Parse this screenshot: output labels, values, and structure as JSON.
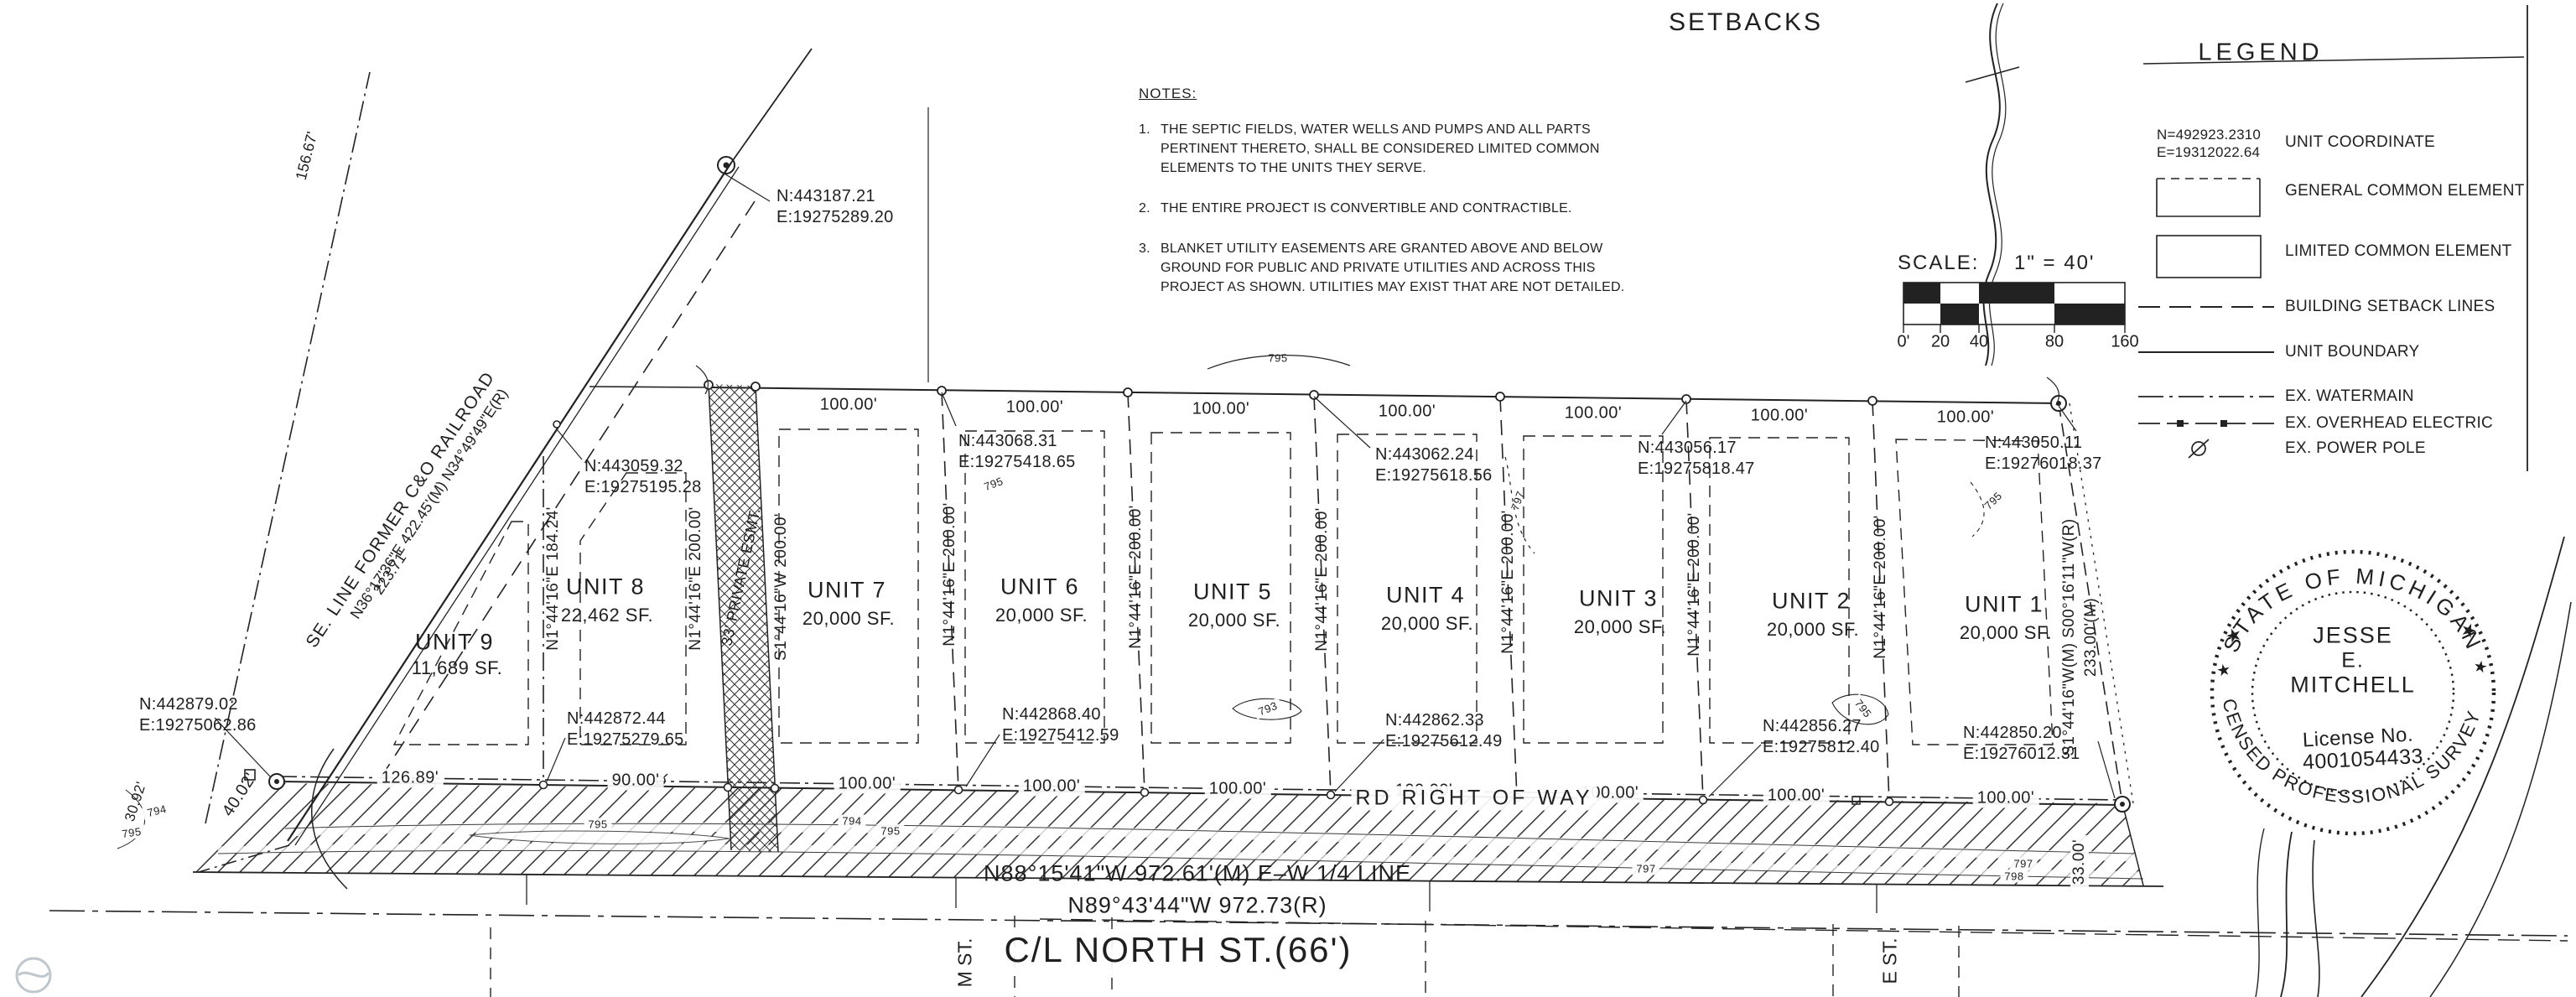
{
  "page": {
    "title": "SETBACKS",
    "ink": "#1f1f1f",
    "bg": "#ffffff"
  },
  "notes": {
    "title": "NOTES:",
    "items": [
      {
        "num": "1.",
        "lines": [
          "THE SEPTIC FIELDS, WATER WELLS AND PUMPS AND ALL PARTS",
          "PERTINENT THERETO, SHALL BE CONSIDERED LIMITED COMMON",
          "ELEMENTS TO THE UNITS THEY SERVE."
        ]
      },
      {
        "num": "2.",
        "lines": [
          "THE ENTIRE PROJECT IS CONVERTIBLE AND CONTRACTIBLE."
        ]
      },
      {
        "num": "3.",
        "lines": [
          "BLANKET UTILITY EASEMENTS ARE GRANTED ABOVE AND BELOW",
          "GROUND FOR PUBLIC AND PRIVATE UTILITIES AND ACROSS THIS",
          "PROJECT AS SHOWN. UTILITIES MAY EXIST THAT ARE NOT DETAILED."
        ]
      }
    ]
  },
  "legend": {
    "title": "LEGEND",
    "coord_sample": {
      "n": "N=492923.2310",
      "e": "E=19312022.64"
    },
    "items": [
      "UNIT COORDINATE",
      "GENERAL COMMON ELEMENT",
      "LIMITED COMMON ELEMENT",
      "BUILDING SETBACK LINES",
      "UNIT BOUNDARY",
      "EX. WATERMAIN",
      "EX. OVERHEAD ELECTRIC",
      "EX. POWER POLE"
    ]
  },
  "scale": {
    "label": "SCALE:",
    "ratio": "1\" = 40'",
    "ticks": [
      "0'",
      "20",
      "40",
      "80",
      "160"
    ]
  },
  "seal": {
    "arc_top": "STATE OF MICHIGAN",
    "arc_bottom": "LICENSED PROFESSIONAL SURVEYOR",
    "name1": "JESSE",
    "name2": "E.",
    "name3": "MITCHELL",
    "license_label": "License No.",
    "license_no": "4001054433",
    "star": "★"
  },
  "railroad": {
    "name": "SE. LINE FORMER C&O RAILROAD",
    "bearing": "N36°17'36\"E  422.45'(M)  N34°49'49\"E(R)",
    "dim_223": "223.71'",
    "dim_156": "156.67'"
  },
  "units": [
    {
      "name": "UNIT 9",
      "sf": "11,689 SF."
    },
    {
      "name": "UNIT 8",
      "sf": "22,462 SF."
    },
    {
      "name": "UNIT 7",
      "sf": "20,000 SF."
    },
    {
      "name": "UNIT 6",
      "sf": "20,000 SF."
    },
    {
      "name": "UNIT 5",
      "sf": "20,000 SF."
    },
    {
      "name": "UNIT 4",
      "sf": "20,000 SF."
    },
    {
      "name": "UNIT 3",
      "sf": "20,000 SF."
    },
    {
      "name": "UNIT 2",
      "sf": "20,000 SF."
    },
    {
      "name": "UNIT 1",
      "sf": "20,000 SF."
    }
  ],
  "coords": {
    "rr_top": {
      "n": "N:443187.21",
      "e": "E:19275289.20"
    },
    "u8_nw": {
      "n": "N:443059.32",
      "e": "E:19275195.28"
    },
    "u6_top": {
      "n": "N:443068.31",
      "e": "E:19275418.65"
    },
    "u4_top": {
      "n": "N:443062.24",
      "e": "E:19275618.56"
    },
    "u2_top": {
      "n": "N:443056.17",
      "e": "E:19275818.47"
    },
    "u1_top": {
      "n": "N:443050.11",
      "e": "E:19276018.37"
    },
    "sw": {
      "n": "N:442879.02",
      "e": "E:19275062.86"
    },
    "b1": {
      "n": "N:442872.44",
      "e": "E:19275279.65"
    },
    "b2": {
      "n": "N:442868.40",
      "e": "E:19275412.59"
    },
    "b3": {
      "n": "N:442862.33",
      "e": "E:19275612.49"
    },
    "b4": {
      "n": "N:442856.27",
      "e": "E:19275812.40"
    },
    "b5": {
      "n": "N:442850.20",
      "e": "E:19276012.31"
    }
  },
  "dims": {
    "d100": "100.00'",
    "d126": "126.89'",
    "d90": "90.00'",
    "d40": "40.02'",
    "d30": "30.92'",
    "d33": "33.00'"
  },
  "bearings": {
    "u9_east": "N1°44'16\"E  184.24'",
    "divider": "N1°44'16\"E  200.00'",
    "easement_w": "N1°44'16\"E  200.00'",
    "easement_label": "33' PRIVATE ESMT.",
    "easement_e": "S1°44'16\"W  200.00'",
    "east_line1": "S1°44'16\"W(M) S00°16'11\"W(R)",
    "east_line2": "233.00'(M)"
  },
  "road": {
    "band_label": "RD RIGHT OF WAY",
    "quarter_m": "N88°15'41\"W  972.61'(M)  E–W 1/4 LINE",
    "quarter_r": "N89°43'44\"W  972.73(R)",
    "street": "C/L NORTH ST.(66')",
    "street_left": "M ST.",
    "street_right": "E ST."
  },
  "contours": {
    "c793": "793",
    "c794": "794",
    "c795": "795",
    "c797": "797",
    "c798": "798"
  }
}
